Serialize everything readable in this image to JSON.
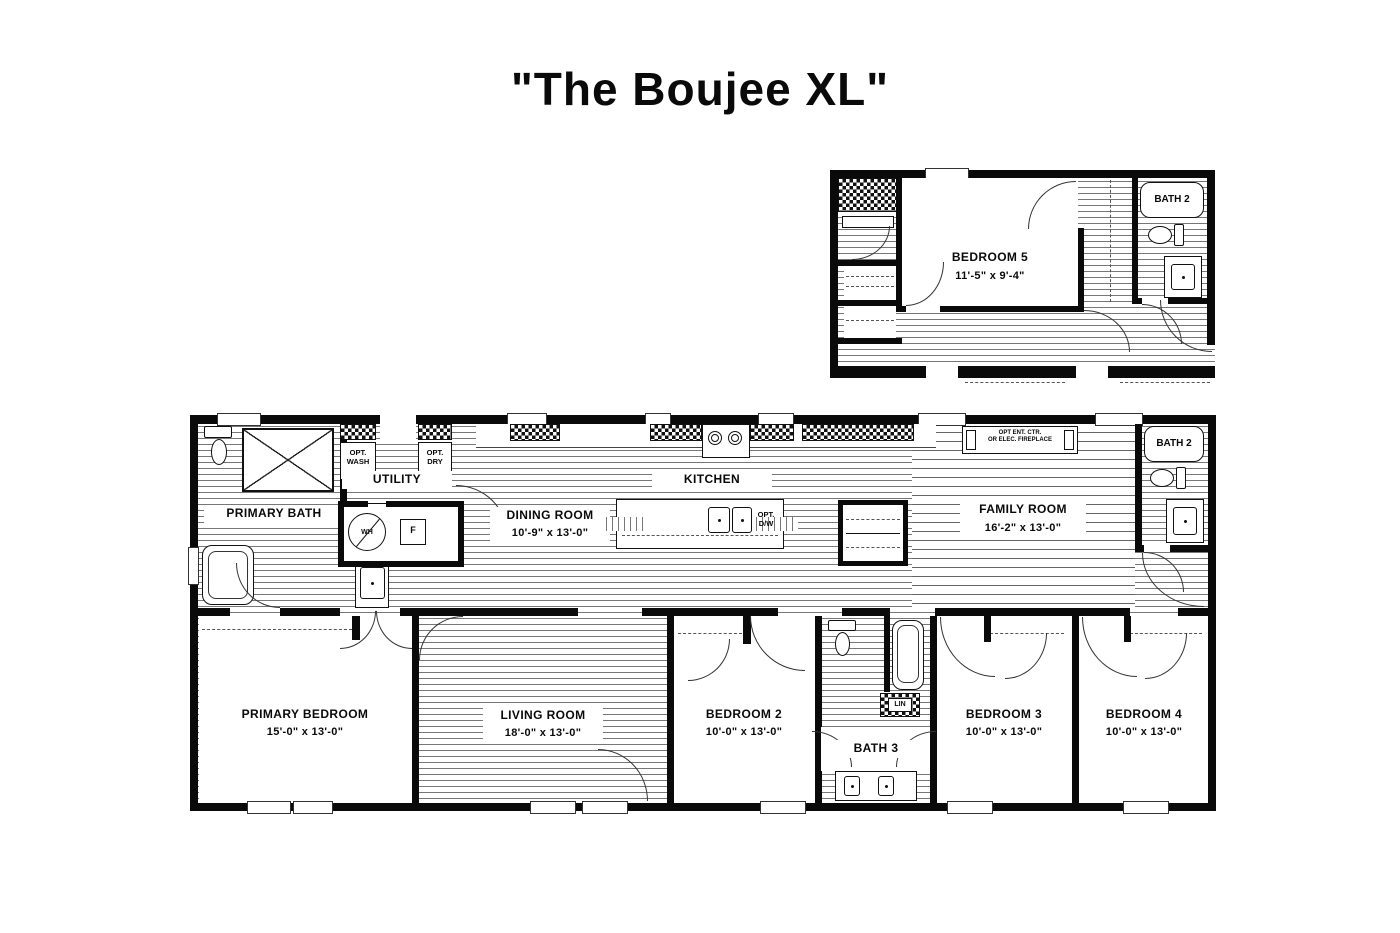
{
  "title": "\"The Boujee XL\"",
  "colors": {
    "wall": "#0a0a0a",
    "floor_line": "#777777",
    "background": "#ffffff"
  },
  "inset": {
    "bedroom5": {
      "label": "BEDROOM 5",
      "dims": "11'-5\" x  9'-4\""
    },
    "bath2": {
      "label": "BATH 2"
    }
  },
  "main": {
    "primary_bath": {
      "label": "PRIMARY BATH"
    },
    "utility": {
      "label": "UTILITY"
    },
    "opt_wash": {
      "line1": "OPT.",
      "line2": "WASH"
    },
    "opt_dry": {
      "line1": "OPT.",
      "line2": "DRY"
    },
    "water_heater": {
      "label": "WH"
    },
    "furnace": {
      "label": "F"
    },
    "dining_room": {
      "label": "DINING ROOM",
      "dims": "10'-9\" x  13'-0\""
    },
    "kitchen": {
      "label": "KITCHEN"
    },
    "opt_dw": {
      "line1": "OPT.",
      "line2": "D/W"
    },
    "fireplace": {
      "line1": "OPT ENT. CTR.",
      "line2": "OR ELEC. FIREPLACE"
    },
    "family_room": {
      "label": "FAMILY ROOM",
      "dims": "16'-2\" x  13'-0\""
    },
    "bath2": {
      "label": "BATH 2"
    },
    "primary_bedroom": {
      "label": "PRIMARY BEDROOM",
      "dims": "15'-0\" x  13'-0\""
    },
    "living_room": {
      "label": "LIVING ROOM",
      "dims": "18'-0\" x  13'-0\""
    },
    "bedroom2": {
      "label": "BEDROOM 2",
      "dims": "10'-0\" x  13'-0\""
    },
    "bath3": {
      "label": "BATH 3"
    },
    "linen": {
      "label": "LIN"
    },
    "bedroom3": {
      "label": "BEDROOM 3",
      "dims": "10'-0\" x  13'-0\""
    },
    "bedroom4": {
      "label": "BEDROOM 4",
      "dims": "10'-0\" x  13'-0\""
    }
  }
}
